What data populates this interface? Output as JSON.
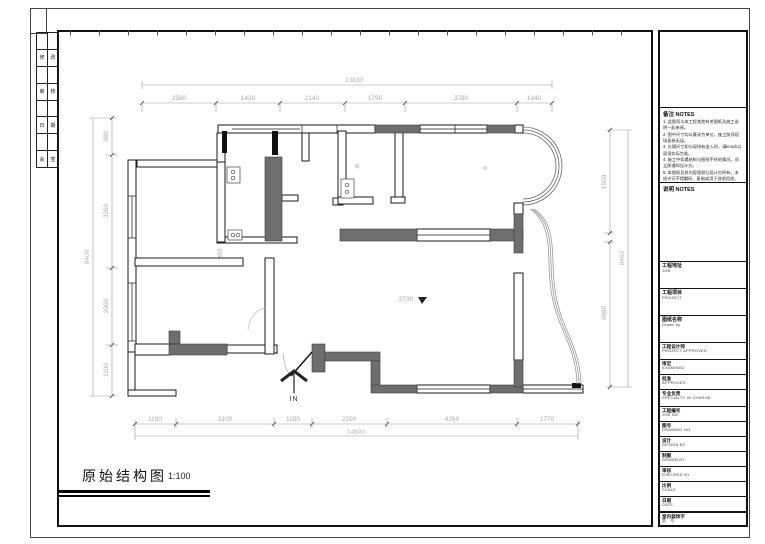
{
  "colors": {
    "wall_gray": "#6e6e6e",
    "line_black": "#1a1a1a",
    "dim_text": "#ababab"
  },
  "sheet": {
    "strip_rows": [
      [
        "",
        ""
      ],
      [
        "修",
        "改"
      ],
      [
        "",
        ""
      ],
      [
        "审",
        "核"
      ],
      [
        "",
        ""
      ],
      [
        "日",
        "期"
      ],
      [
        "",
        ""
      ],
      [
        "会",
        "签"
      ]
    ]
  },
  "plan": {
    "title": "原始结构图",
    "scale": "1:100",
    "entry_label": "IN",
    "ceiling_height": "2730",
    "interior_dim": "980",
    "dims_top": {
      "total": "13830",
      "segments": [
        "2580",
        "1430",
        "2140",
        "1790",
        "3780",
        "1340"
      ]
    },
    "dims_bottom": {
      "total": "14500",
      "segments": [
        "1180",
        "3100",
        "1150",
        "2200",
        "4260",
        "1770"
      ]
    },
    "dims_left": {
      "total": "8400",
      "segments": [
        "980",
        "3260",
        "2060",
        "1100"
      ]
    },
    "dims_right": {
      "total": "8460",
      "segments": [
        "1500",
        "4860"
      ]
    }
  },
  "titleblock": {
    "notes_header": "备注 NOTES",
    "notes": [
      "1. 此图须与本工程其他有关图纸及施工说明一起参阅。",
      "2. 图中尺寸均以毫米为单位，施工前须现场复核无误。",
      "3. 分隔尺寸如与现场有出入时，请knock以现场实际为准。",
      "4. 施工中如遇结构与图纸不符的情况，须立即通知设计方。",
      "5. 本图纸及其内容版权归设计方所有，未经许可不得翻印、复制或用于其他用途。"
    ],
    "notes2_header": "说明 NOTES",
    "rows": [
      {
        "cn": "工程地址",
        "en": "JOB"
      },
      {
        "cn": "工程项目",
        "en": "PROJECT"
      },
      {
        "cn": "图纸名称",
        "en": "Drawn by"
      },
      {
        "cn": "工程设计师",
        "en": "PROJECT APPROVED"
      },
      {
        "cn": "审定",
        "en": "EXAMINED"
      },
      {
        "cn": "批准",
        "en": "APPROVED"
      },
      {
        "cn": "专业负责",
        "en": "SPECIALTY IN CHARGE"
      },
      {
        "cn": "工程编号",
        "en": "JOB NO."
      },
      {
        "cn": "图号",
        "en": "DRAWING NO."
      },
      {
        "cn": "设计",
        "en": "DESIGN BY"
      },
      {
        "cn": "制图",
        "en": "DRAWN BY"
      },
      {
        "cn": "审核",
        "en": "CHECKED BY"
      },
      {
        "cn": "比例",
        "en": "SCALE"
      },
      {
        "cn": "日期",
        "en": "DATE"
      },
      {
        "cn": "室内装饰字",
        "en": "第　号"
      }
    ]
  }
}
